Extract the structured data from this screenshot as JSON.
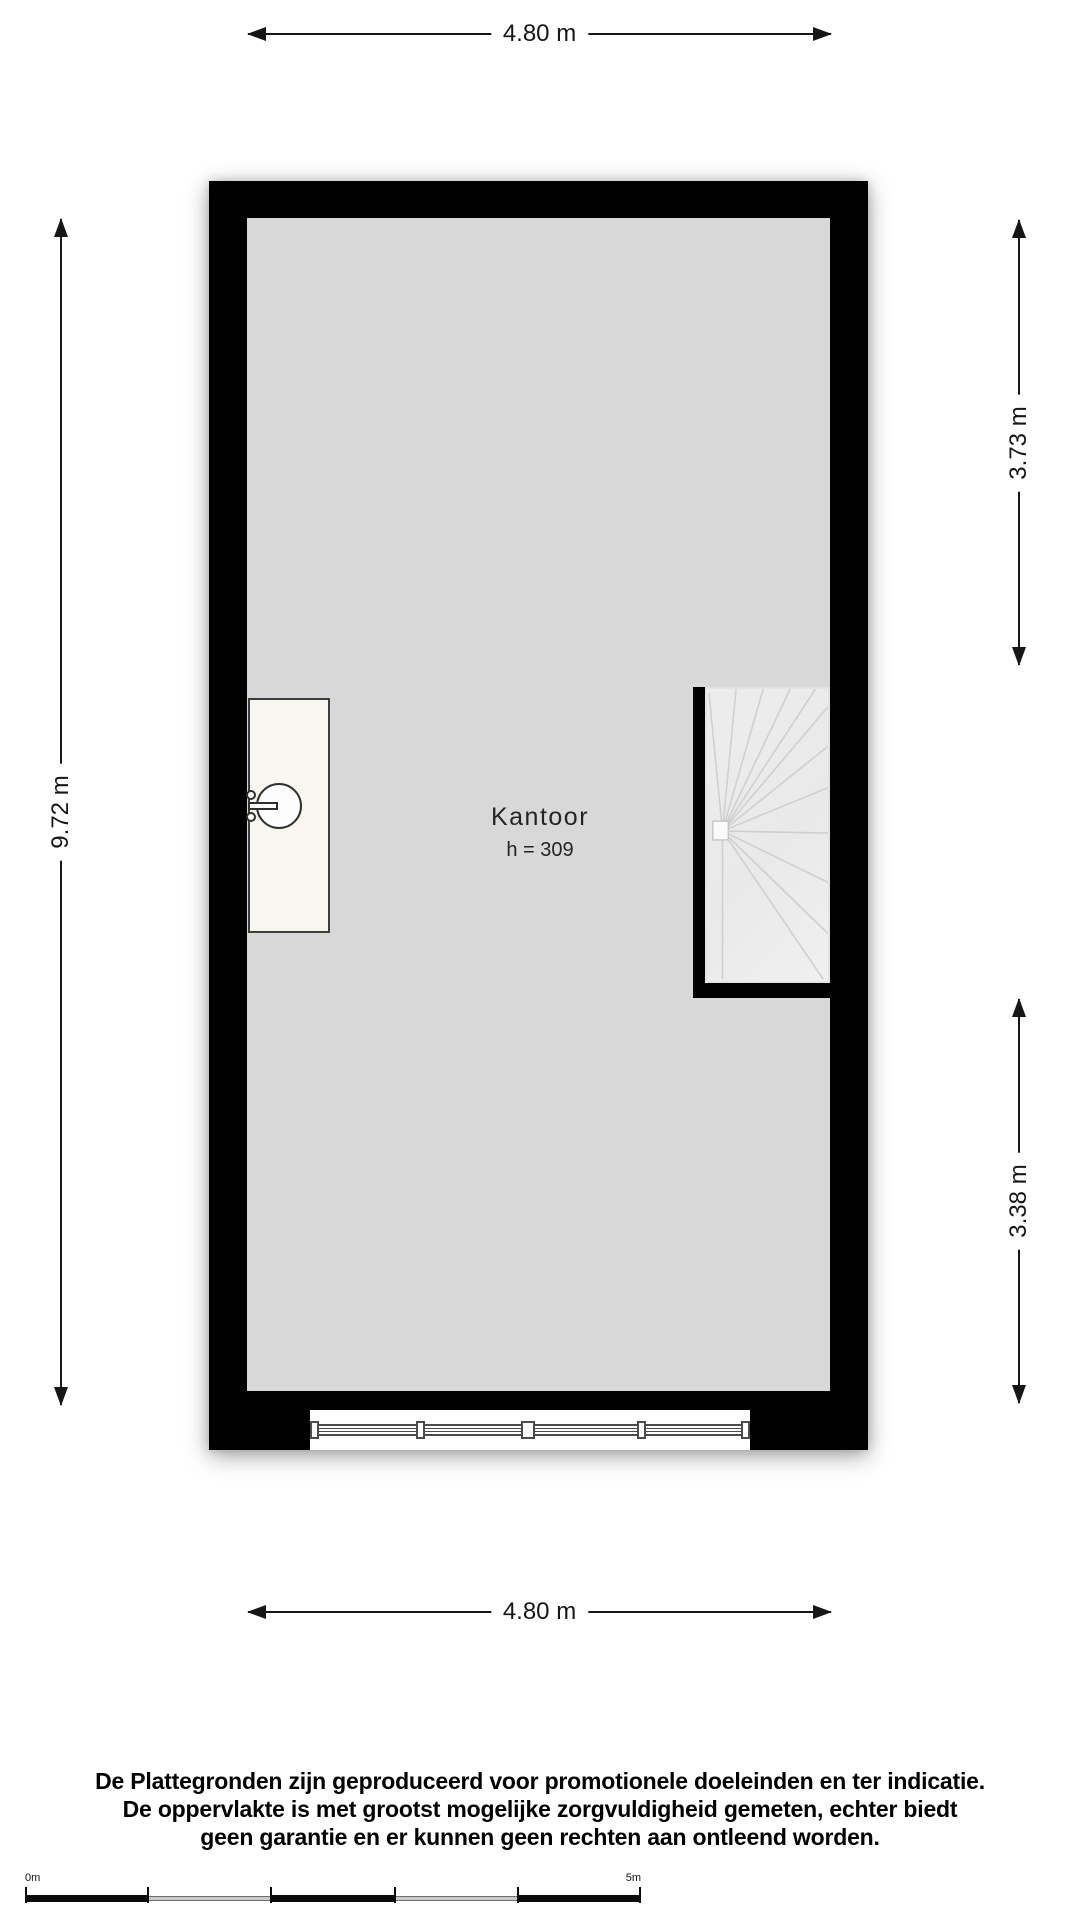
{
  "floorplan": {
    "room": {
      "name": "Kantoor",
      "height_label": "h = 309"
    },
    "dimensions": {
      "top": "4.80 m",
      "bottom": "4.80 m",
      "left": "9.72 m",
      "right_upper": "3.73 m",
      "right_lower": "3.38 m"
    },
    "colors": {
      "wall": "#000000",
      "floor": "#d8d8d8",
      "stairs": "#ececec",
      "counter": "#f8f6f0",
      "background": "#ffffff"
    }
  },
  "disclaimer": {
    "lines": [
      "De Plattegronden zijn geproduceerd voor promotionele doeleinden en ter indicatie.",
      "De oppervlakte is met grootst mogelijke zorgvuldigheid gemeten, echter biedt",
      "geen garantie en er kunnen geen rechten aan ontleend worden."
    ]
  },
  "scalebar": {
    "start_label": "0m",
    "end_label": "5m"
  }
}
